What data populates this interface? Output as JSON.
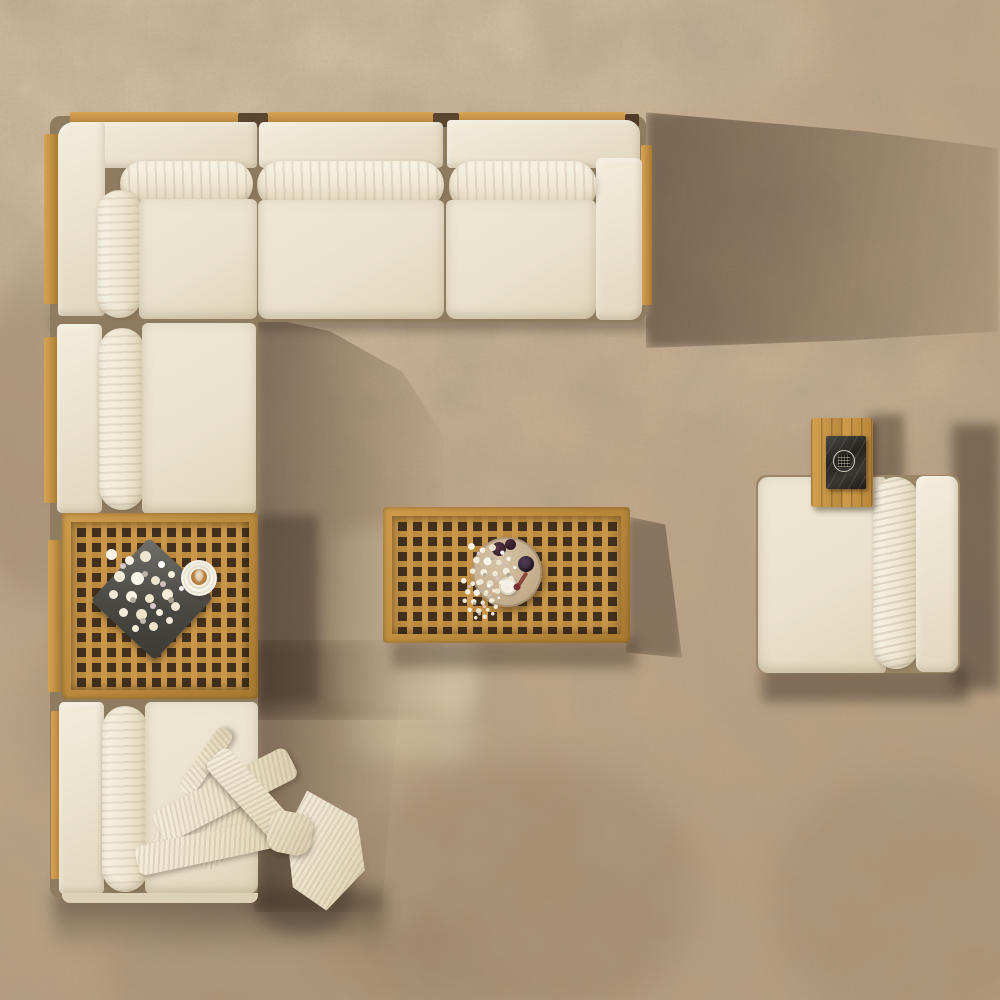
{
  "scene": {
    "title": "Top view of an outdoor teak sectional sofa set on a beige concrete floor",
    "objects": {
      "sofa": "L-shaped cream fabric sectional sofa with teak wood frame",
      "left_table": "square teak lattice coffee-table module between sofa seats",
      "center_table": "rectangular teak lattice coffee table",
      "chair": "cream lounge chair with attached teak side table",
      "blanket": "cream ribbed throw blanket draped over the bottom seat",
      "round_tray": "round wooden tray with flowers, plums, berries and a cup",
      "coffee": "latte on a white saucer",
      "flower_tray": "slate tray with a white flower bouquet",
      "marble_board": "black marble board with a round emblem on the chair side table"
    }
  },
  "palette": {
    "floor_base": "#c2a98c",
    "floor_light": "#d2bfa4",
    "cushion": "#eae1cc",
    "wood_light": "#c9964a",
    "wood_dark": "#a87a2f",
    "lattice_gap": "#42301d",
    "frame_shade": "#8f7c60",
    "slate": "#3b3a35",
    "marble": "#26241f",
    "coffee": "#b57f41",
    "shadow": "#42321f"
  }
}
